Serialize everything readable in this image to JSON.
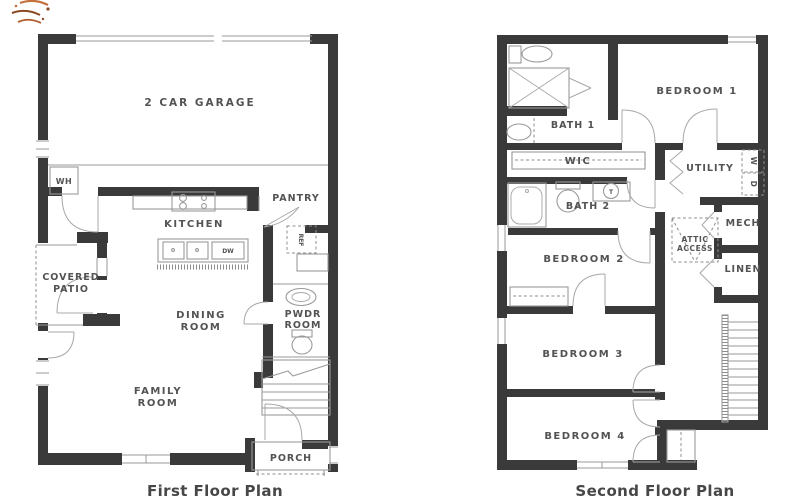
{
  "sheet": {
    "background": "#ffffff"
  },
  "colors": {
    "wall": "#3a3a3a",
    "thin_line": "#9a9a9a",
    "label": "#535353",
    "caption": "#474747",
    "logo_orange": "#c4713b",
    "logo_brown": "#8a4a22"
  },
  "first_floor": {
    "caption": "First Floor Plan",
    "labels": {
      "garage": "2 CAR GARAGE",
      "water_heater": "WH",
      "kitchen": "KITCHEN",
      "pantry": "PANTRY",
      "refrigerator": "REF",
      "dishwasher": "DW",
      "covered_patio_1": "COVERED",
      "covered_patio_2": "PATIO",
      "dining_1": "DINING",
      "dining_2": "ROOM",
      "powder_1": "PWDR",
      "powder_2": "ROOM",
      "family_1": "FAMILY",
      "family_2": "ROOM",
      "porch": "PORCH"
    }
  },
  "second_floor": {
    "caption": "Second Floor Plan",
    "labels": {
      "bath1": "BATH 1",
      "bedroom1": "BEDROOM 1",
      "wic": "WIC",
      "utility": "UTILITY",
      "washer": "W",
      "dryer": "D",
      "bath2": "BATH 2",
      "faucet": "T",
      "mech": "MECH",
      "attic_1": "ATTIC",
      "attic_2": "ACCESS",
      "linen": "LINEN",
      "bedroom2": "BEDROOM 2",
      "bedroom3": "BEDROOM 3",
      "bedroom4": "BEDROOM 4"
    }
  }
}
